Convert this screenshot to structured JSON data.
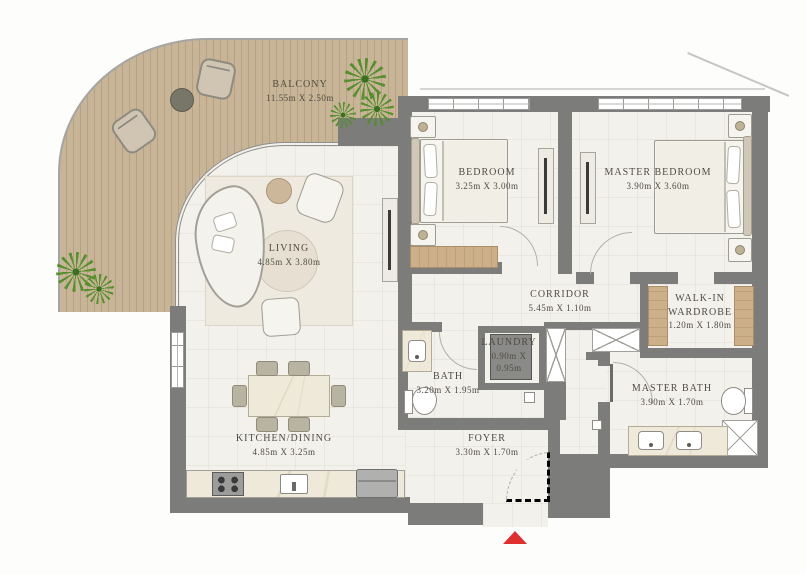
{
  "plan": {
    "title": "Apartment floor plan",
    "rooms": {
      "balcony": {
        "name": "BALCONY",
        "dims": "11.55m X 2.50m"
      },
      "living": {
        "name": "LIVING",
        "dims": "4.85m X 3.80m"
      },
      "bedroom": {
        "name": "BEDROOM",
        "dims": "3.25m X 3.00m"
      },
      "master_bedroom": {
        "name": "MASTER BEDROOM",
        "dims": "3.90m X 3.60m"
      },
      "corridor": {
        "name": "CORRIDOR",
        "dims": "5.45m X 1.10m"
      },
      "walk_in_wardrobe": {
        "name": "WALK-IN WARDROBE",
        "dims": "1.20m X 1.80m"
      },
      "laundry": {
        "name": "LAUNDRY",
        "dims": "0.90m X 0.95m"
      },
      "bath": {
        "name": "BATH",
        "dims": "3.20m X 1.95m"
      },
      "master_bath": {
        "name": "MASTER BATH",
        "dims": "3.90m X 1.70m"
      },
      "kitchen_dining": {
        "name": "KITCHEN/DINING",
        "dims": "4.85m X 3.25m"
      },
      "foyer": {
        "name": "FOYER",
        "dims": "3.30m X 1.70m"
      }
    },
    "colors": {
      "wall": "#7c7c7b",
      "deck_wood": "#c8b496",
      "floor": "#f3f1ec",
      "closet_wood": "#cbb08a",
      "plant_green": "#4e8f27",
      "label_text": "#4f4c42",
      "entry_marker_red": "#e02f2f"
    },
    "icons": {
      "plant-icon": "top-view shrub (radial fronds)",
      "entry-marker-icon": "red triangle pointing up at entrance"
    }
  }
}
